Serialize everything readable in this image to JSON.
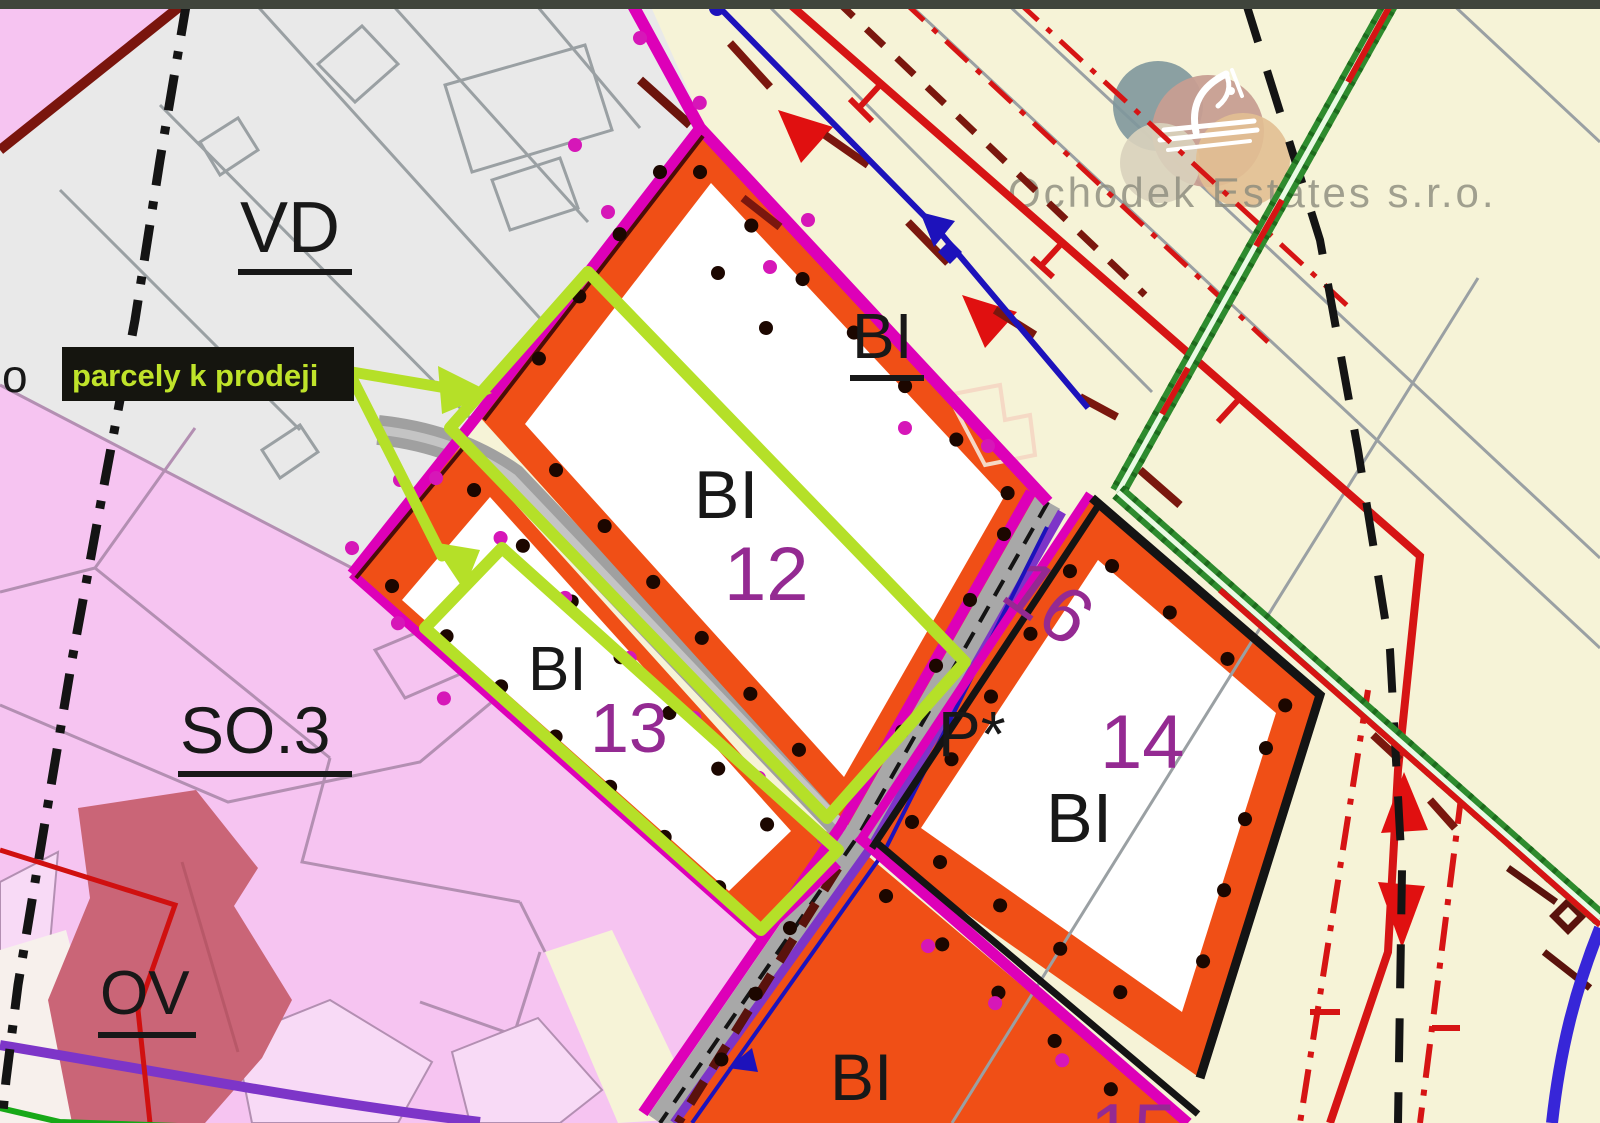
{
  "map": {
    "kind": "municipal zoning plan detail",
    "watermark": {
      "company": "Ochodek Estates s.r.o."
    },
    "annotation": {
      "sale_note": "parcely k prodeji"
    },
    "edge_label": "o",
    "zone_labels": {
      "vd": "VD",
      "so3": "SO.3",
      "ov": "OV",
      "bi_top": "BI",
      "bi12_code": "BI",
      "bi12_num": "12",
      "bi13_code": "BI",
      "bi13_num": "13",
      "bi14_code": "BI",
      "bi14_num": "14",
      "bi15_code": "BI",
      "bi15_num": "15",
      "p_star": "P*",
      "p16_num": "16"
    },
    "colors": {
      "cream_bg": "#f6f3d7",
      "gray_zone": "#e9e9e9",
      "pink_zone": "#f6c4f1",
      "light_pink_parcel": "#f8daf6",
      "rose_zone": "#ca6577",
      "orange_zone": "#f04f16",
      "white_parcel": "#ffffff",
      "magenta_border": "#dd00b8",
      "chartreuse_highlight": "#b5e028",
      "purple_label": "#942a92",
      "road_purple": "#7d35c8",
      "railway_green": "#2e8b2e",
      "line_red": "#d61414",
      "line_dark_red": "#7a170e",
      "line_blue": "#1d12bb",
      "cadastre_black": "#141414",
      "note_box": "#15150f",
      "note_text": "#bfe32a"
    }
  }
}
